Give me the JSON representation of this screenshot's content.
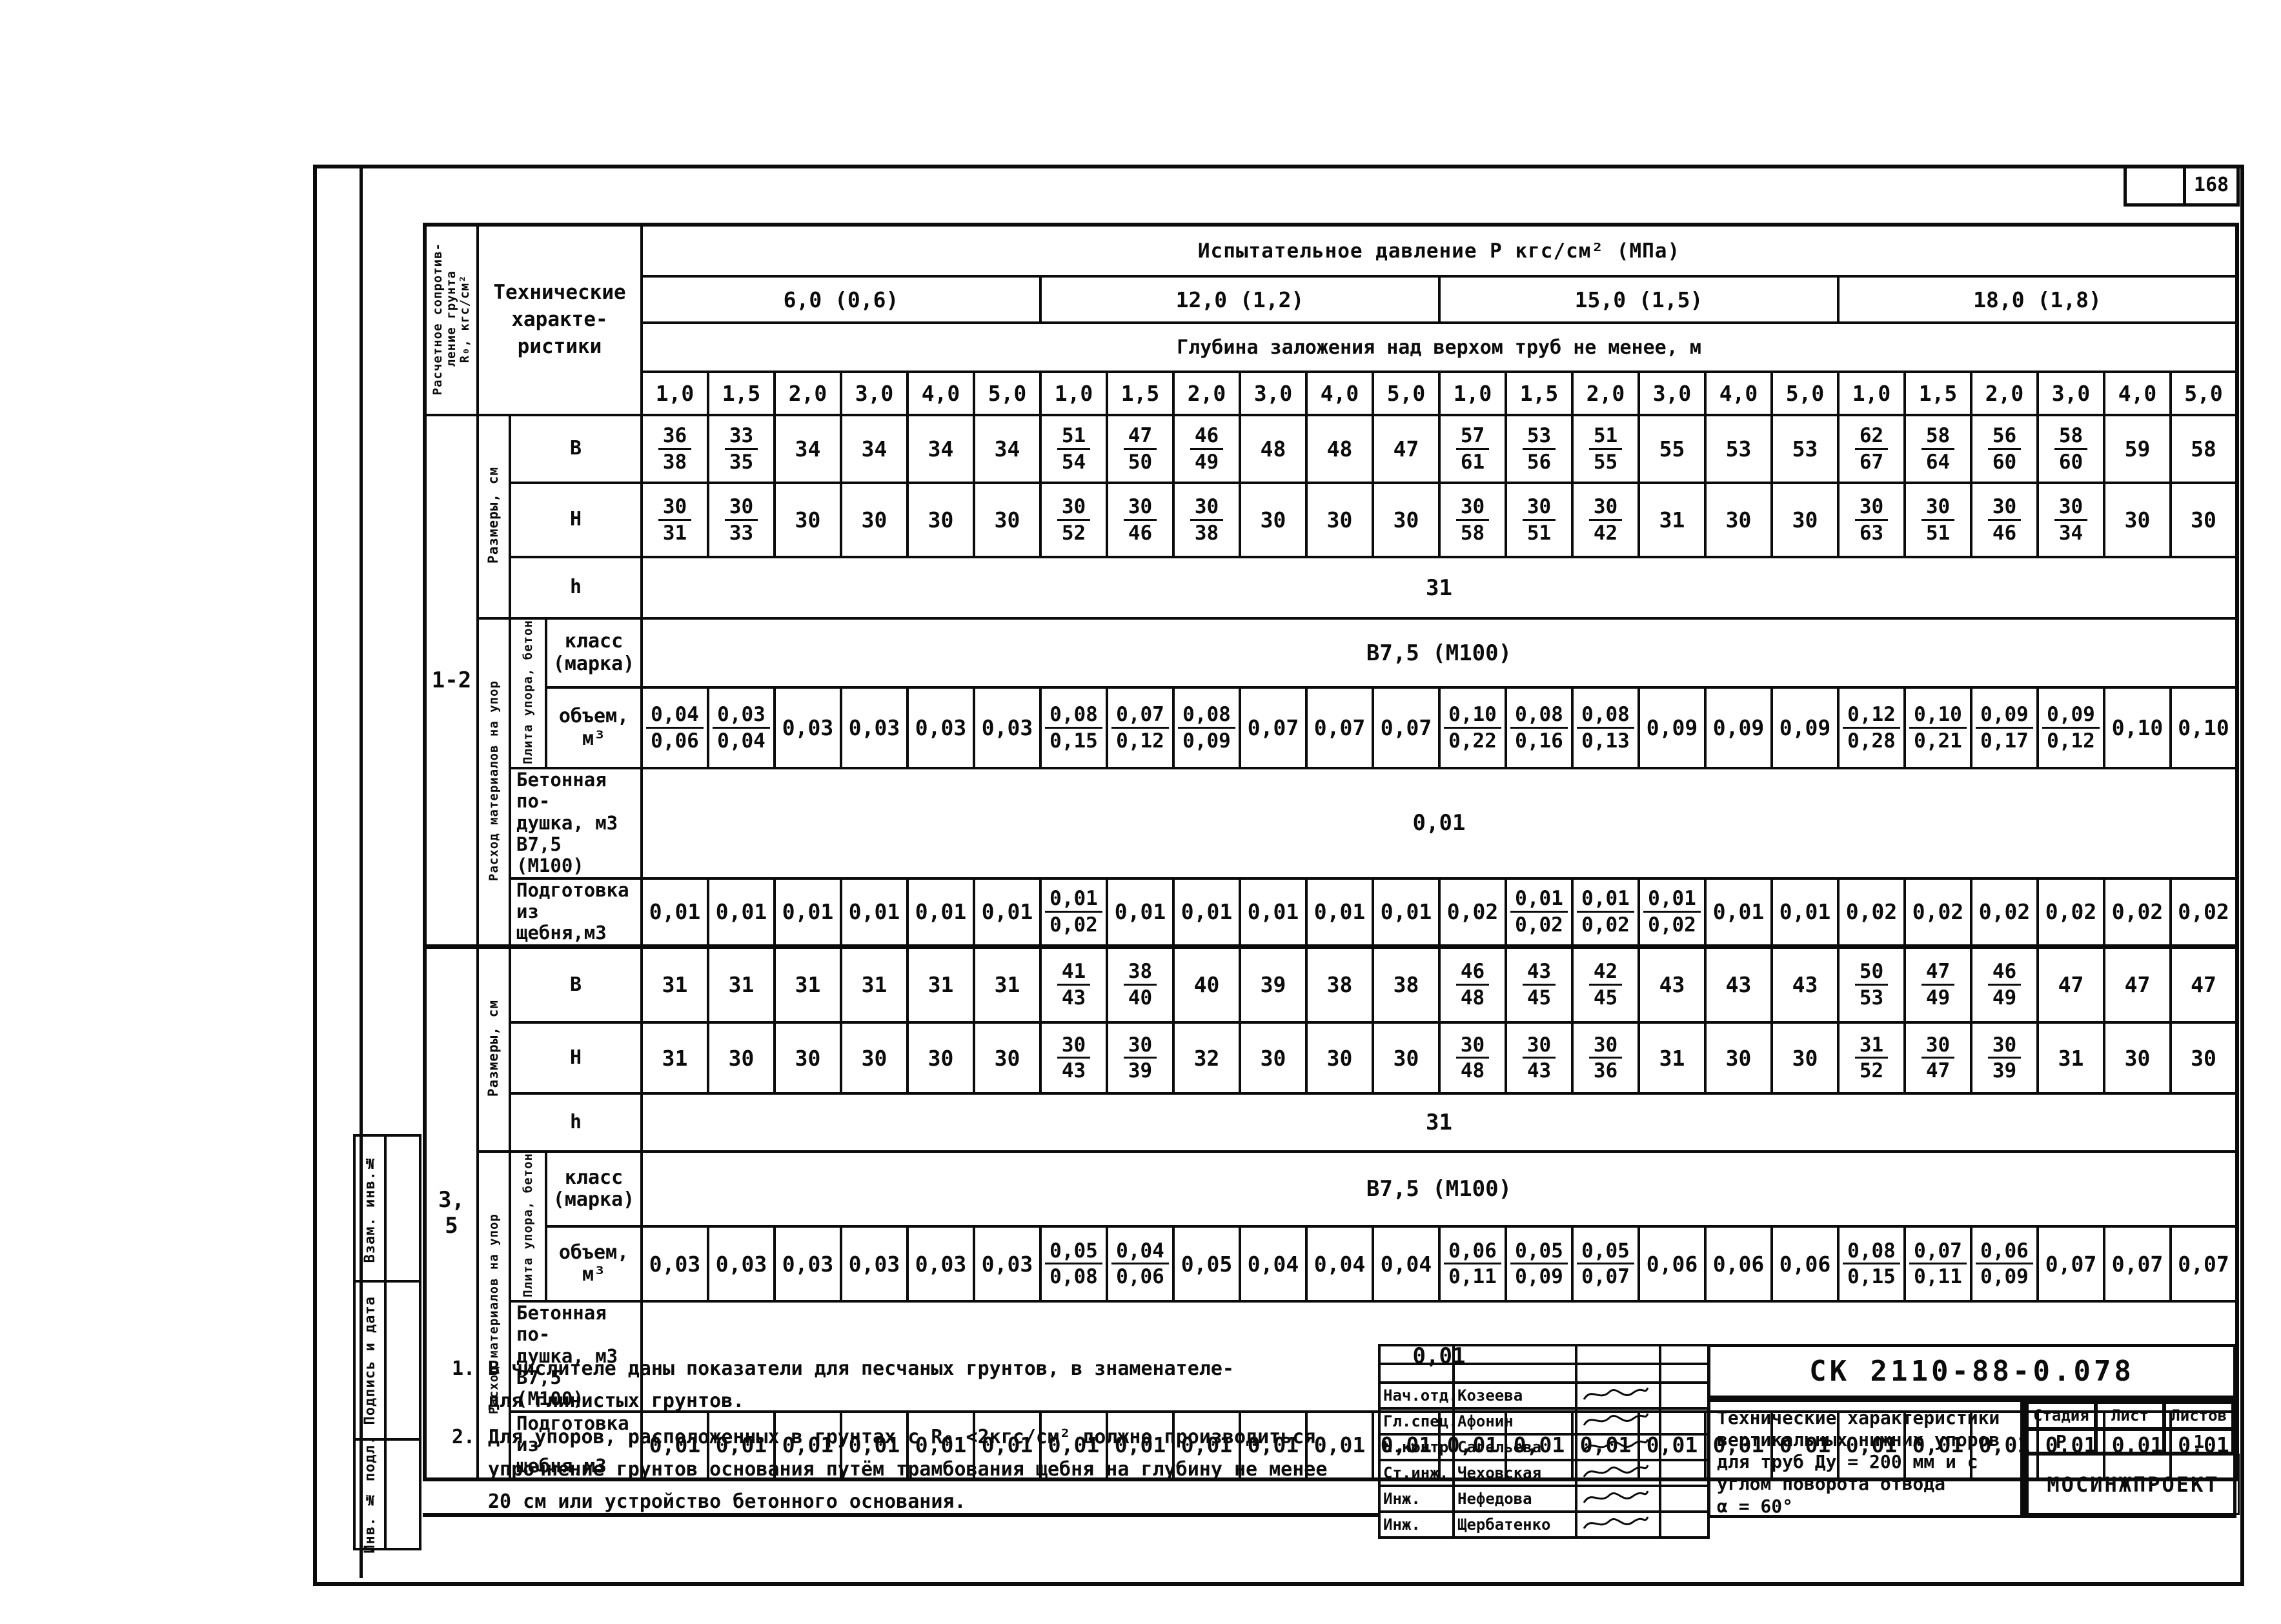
{
  "page": {
    "number": "168"
  },
  "margin_stamps": [
    "Взам. инв.№",
    "Подпись и дата",
    "Инв. № подл."
  ],
  "table": {
    "left_header_lines": [
      "Расчетное сопротив-",
      "ление грунта",
      "R₀, кгс/см²"
    ],
    "corner_lines": [
      "Технические",
      "характе-",
      "ристики"
    ],
    "pressure_header": "Испытательное давление   Р    кгс/см²    (МПа)",
    "pressure_groups": [
      "6,0 (0,6)",
      "12,0 (1,2)",
      "15,0 (1,5)",
      "18,0 (1,8)"
    ],
    "depth_header": "Глубина заложения над верхом труб не менее,    м",
    "depths": [
      "1,0",
      "1,5",
      "2,0",
      "3,0",
      "4,0",
      "5,0"
    ],
    "side_labels": {
      "razmery": "Размеры, см",
      "rashod": "Расход материалов на упор",
      "plita": "Плита упора, бетон"
    },
    "row_labels": {
      "b": "В",
      "h_cap": "Н",
      "h_small": "h",
      "klass_lines": [
        "класс",
        "(марка)"
      ],
      "volume_lines": [
        "объем,",
        "м³"
      ],
      "podushka_lines": [
        "Бетонная по-",
        "душка, м3",
        "В7,5 (М100)"
      ],
      "podgotovka_lines": [
        "Подготовка",
        "из щебня,м3"
      ]
    },
    "groups": [
      {
        "r_value": "1-2",
        "b": [
          "36/38",
          "33/35",
          "34",
          "34",
          "34",
          "34",
          "51/54",
          "47/50",
          "46/49",
          "48",
          "48",
          "47",
          "57/61",
          "53/56",
          "51/55",
          "55",
          "53",
          "53",
          "62/67",
          "58/64",
          "56/60",
          "58/60",
          "59",
          "58"
        ],
        "h": [
          "30/31",
          "30/33",
          "30",
          "30",
          "30",
          "30",
          "30/52",
          "30/46",
          "30/38",
          "30",
          "30",
          "30",
          "30/58",
          "30/51",
          "30/42",
          "31",
          "30",
          "30",
          "30/63",
          "30/51",
          "30/46",
          "30/34",
          "30",
          "30"
        ],
        "h_span": "31",
        "klass_span": "В7,5 (М100)",
        "volume": [
          "0,04/0,06",
          "0,03/0,04",
          "0,03",
          "0,03",
          "0,03",
          "0,03",
          "0,08/0,15",
          "0,07/0,12",
          "0,08/0,09",
          "0,07",
          "0,07",
          "0,07",
          "0,10/0,22",
          "0,08/0,16",
          "0,08/0,13",
          "0,09",
          "0,09",
          "0,09",
          "0,12/0,28",
          "0,10/0,21",
          "0,09/0,17",
          "0,09/0,12",
          "0,10",
          "0,10"
        ],
        "podushka_span": "0,01",
        "podgotovka": [
          "0,01",
          "0,01",
          "0,01",
          "0,01",
          "0,01",
          "0,01",
          "0,01/0,02",
          "0,01",
          "0,01",
          "0,01",
          "0,01",
          "0,01",
          "0,02",
          "0,01/0,02",
          "0,01/0,02",
          "0,01/0,02",
          "0,01",
          "0,01",
          "0,02",
          "0,02",
          "0,02",
          "0,02",
          "0,02",
          "0,02"
        ]
      },
      {
        "r_value": "3, 5",
        "b": [
          "31",
          "31",
          "31",
          "31",
          "31",
          "31",
          "41/43",
          "38/40",
          "40",
          "39",
          "38",
          "38",
          "46/48",
          "43/45",
          "42/45",
          "43",
          "43",
          "43",
          "50/53",
          "47/49",
          "46/49",
          "47",
          "47",
          "47"
        ],
        "h": [
          "31",
          "30",
          "30",
          "30",
          "30",
          "30",
          "30/43",
          "30/39",
          "32",
          "30",
          "30",
          "30",
          "30/48",
          "30/43",
          "30/36",
          "31",
          "30",
          "30",
          "31/52",
          "30/47",
          "30/39",
          "31",
          "30",
          "30"
        ],
        "h_span": "31",
        "klass_span": "В7,5 (М100)",
        "volume": [
          "0,03",
          "0,03",
          "0,03",
          "0,03",
          "0,03",
          "0,03",
          "0,05/0,08",
          "0,04/0,06",
          "0,05",
          "0,04",
          "0,04",
          "0,04",
          "0,06/0,11",
          "0,05/0,09",
          "0,05/0,07",
          "0,06",
          "0,06",
          "0,06",
          "0,08/0,15",
          "0,07/0,11",
          "0,06/0,09",
          "0,07",
          "0,07",
          "0,07"
        ],
        "podushka_span": "0,01",
        "podgotovka": [
          "0,01",
          "0,01",
          "0,01",
          "0,01",
          "0,01",
          "0,01",
          "0,01",
          "0,01",
          "0,01",
          "0,01",
          "0,01",
          "0,01",
          "0,01",
          "0,01",
          "0,01",
          "0,01",
          "0,01",
          "0 01",
          "0,01",
          "0,01",
          "0,01",
          "0,01",
          "0,01",
          "0,01"
        ]
      }
    ]
  },
  "notes": [
    {
      "num": "1.",
      "lines": [
        "В числителе даны показатели для песчаных грунтов, в знаменателе-",
        "для глинистых грунтов."
      ]
    },
    {
      "num": "2.",
      "lines": [
        "Для упоров, расположенных в грунтах с R₀ <2кгс/см² должно производиться",
        "упрочнение грунтов основания путём трамбования щебня на глубину не менее",
        "20 см или устройство бетонного основания."
      ]
    }
  ],
  "title_block": {
    "doc_number": "СК 2110-88-0.078",
    "title_lines": [
      "Технические характеристики",
      "вертикальных нижних упоров",
      "для труб Ду = 200  мм и с",
      "углом поворота отвода",
      "α = 60°"
    ],
    "stage_headers": [
      "Стадия",
      "Лист",
      "Листов"
    ],
    "stage_values": [
      "Р",
      "",
      "1"
    ],
    "org_name": "МОСИНЖПРОЕКТ",
    "signatures": [
      {
        "role": "Нач.отд.",
        "name": "Козеева"
      },
      {
        "role": "Гл.спец.",
        "name": "Афонин"
      },
      {
        "role": "Н.контр.",
        "name": "Сагельева"
      },
      {
        "role": "Ст.инж.",
        "name": "Чеховская"
      },
      {
        "role": "Инж.",
        "name": "Нефедова"
      },
      {
        "role": "Инж.",
        "name": "Щербатенко"
      }
    ]
  }
}
